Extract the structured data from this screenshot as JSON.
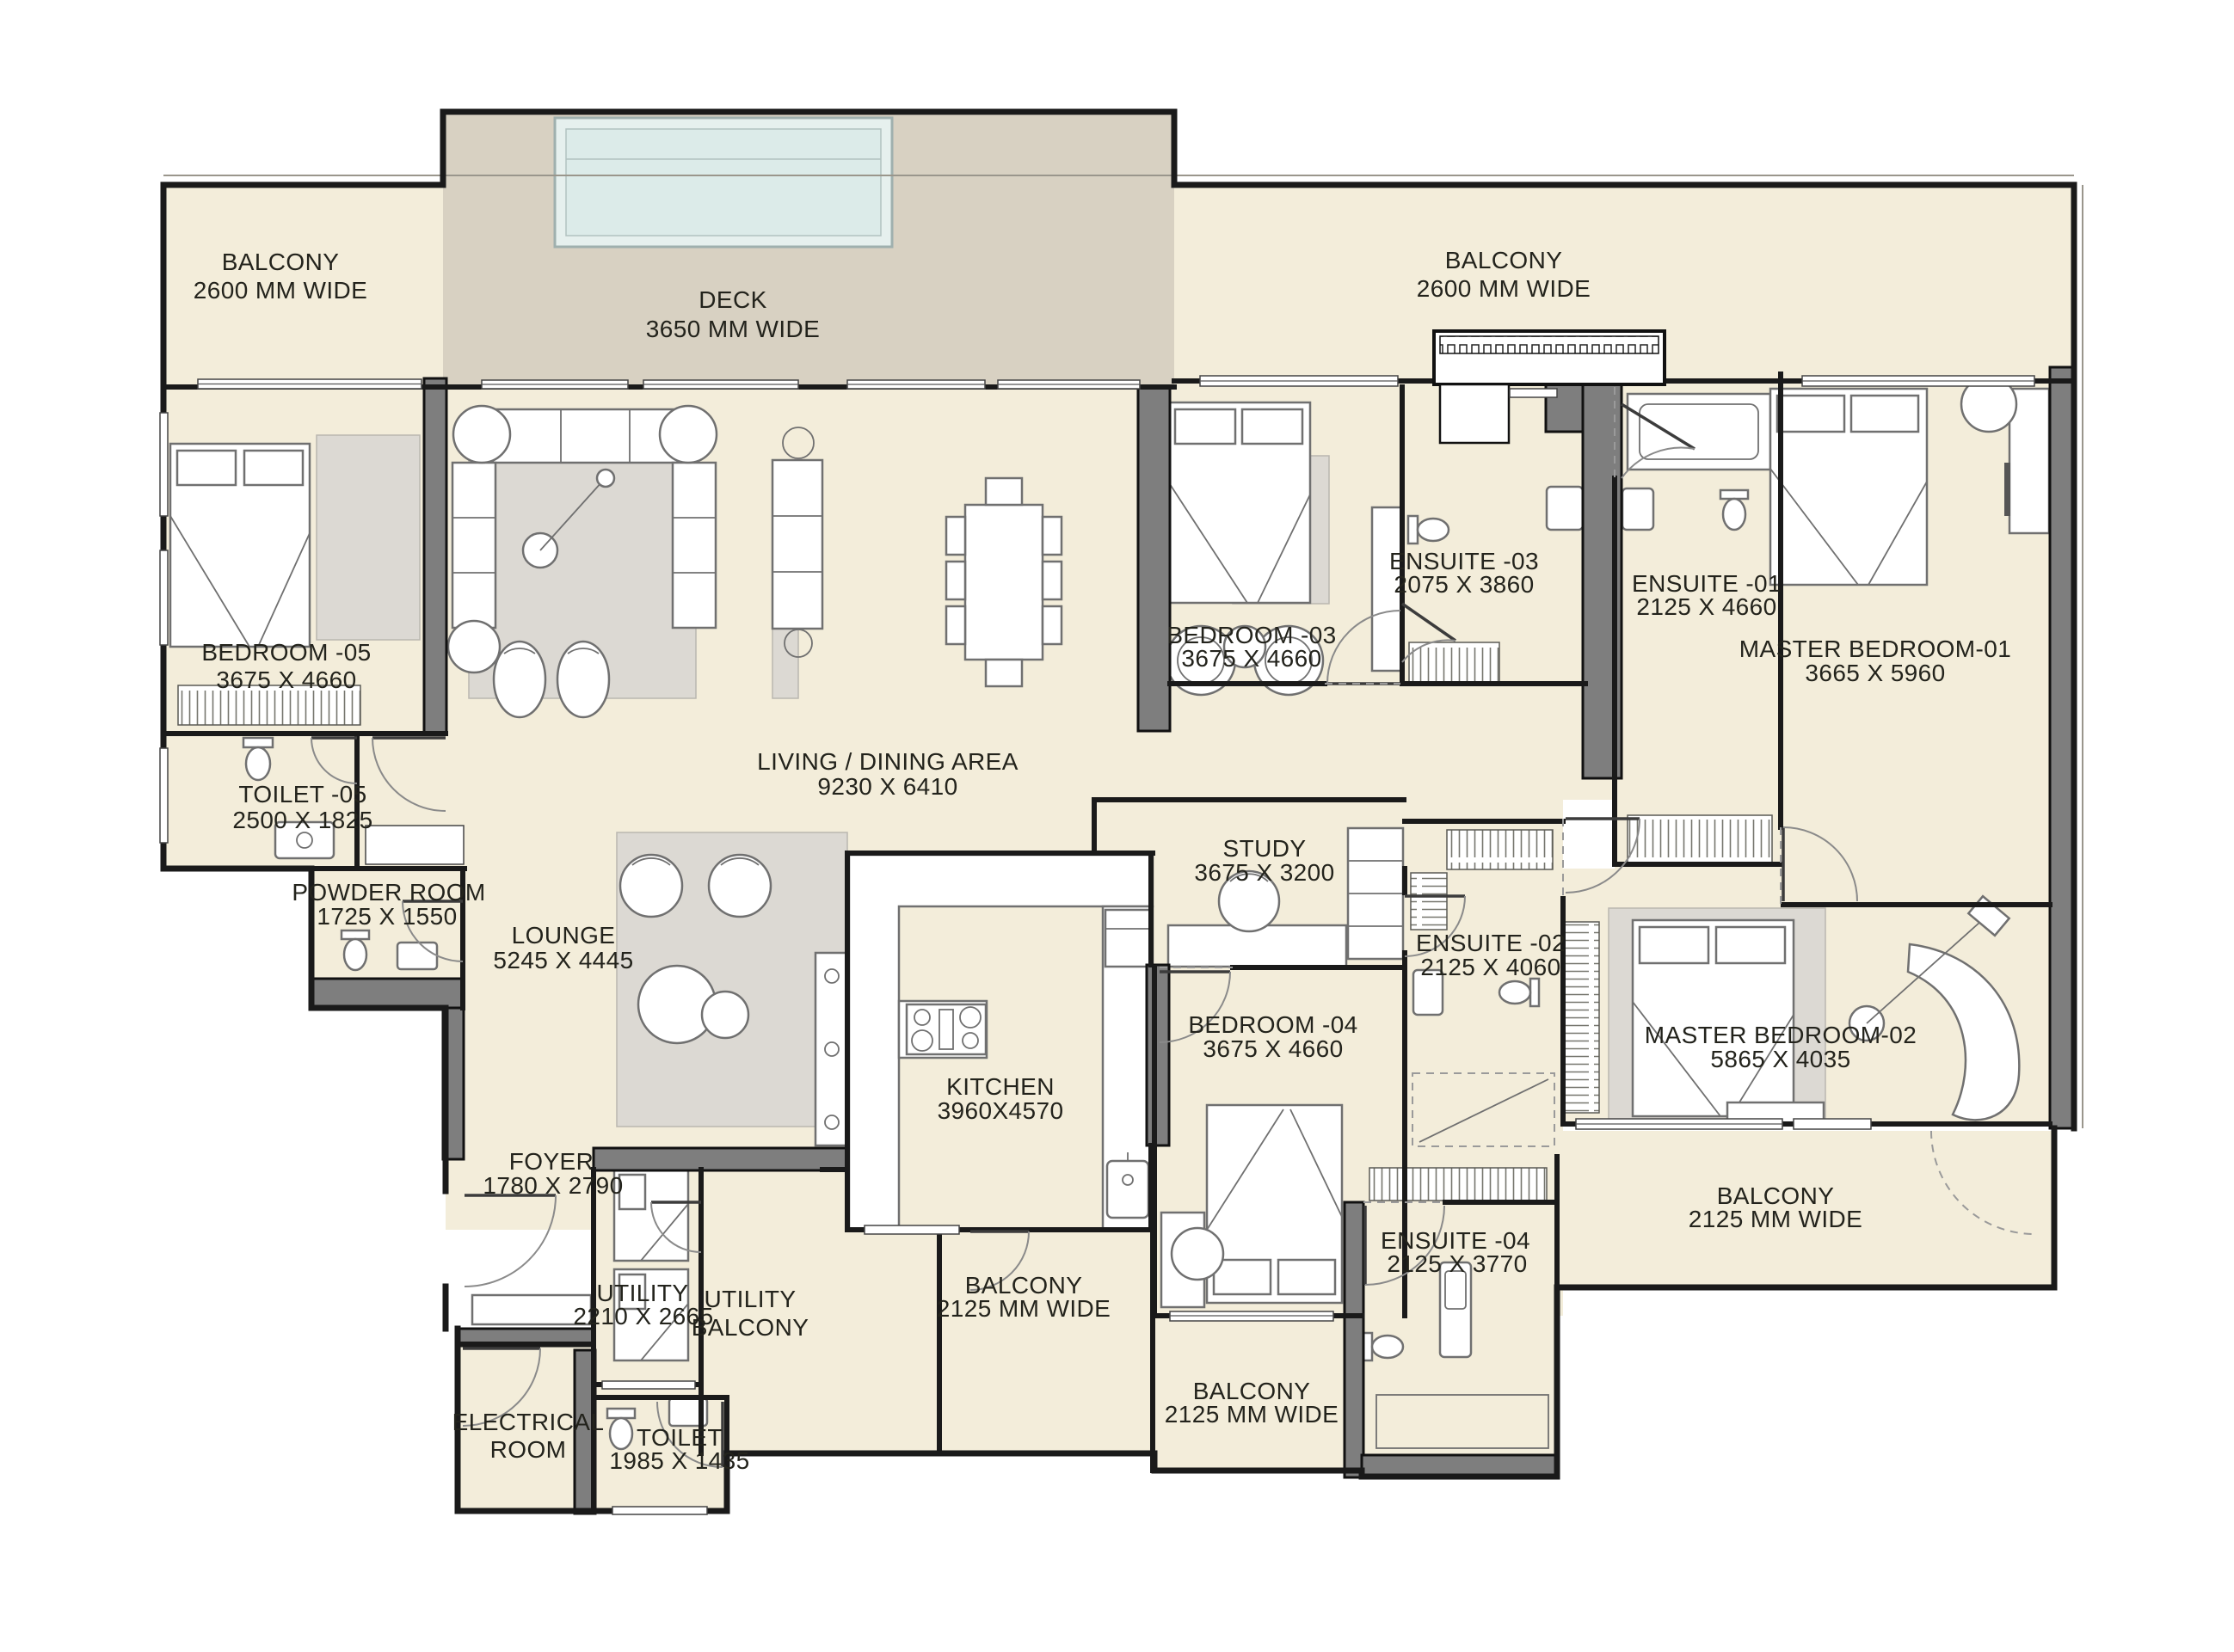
{
  "plan_title": "apartment floor plan",
  "palette": {
    "floor_cream": "#f3edda",
    "deck_taupe": "#d8d1c2",
    "pool_blue": "#dcebe9",
    "wall_black": "#1a1a1a",
    "wall_gray": "#7e7e7e",
    "furniture_stroke": "#707070",
    "rug_gray": "#dcd9d3",
    "label_color": "#23231c"
  },
  "rooms": [
    {
      "id": "balcony-top-left",
      "line1": "BALCONY",
      "line2": "2600 MM WIDE"
    },
    {
      "id": "deck",
      "line1": "DECK",
      "line2": "3650 MM WIDE"
    },
    {
      "id": "balcony-top-right",
      "line1": "BALCONY",
      "line2": "2600 MM WIDE"
    },
    {
      "id": "bedroom-05",
      "line1": "BEDROOM -05",
      "line2": "3675 X 4660"
    },
    {
      "id": "toilet-05",
      "line1": "TOILET -05",
      "line2": "2500 X 1825"
    },
    {
      "id": "powder-room",
      "line1": "POWDER  ROOM",
      "line2": "1725 X 1550"
    },
    {
      "id": "living-dining",
      "line1": "LIVING / DINING AREA",
      "line2": "9230 X 6410"
    },
    {
      "id": "lounge",
      "line1": "LOUNGE",
      "line2": "5245 X 4445"
    },
    {
      "id": "bedroom-03",
      "line1": "BEDROOM -03",
      "line2": "3675 X 4660"
    },
    {
      "id": "ensuite-03",
      "line1": "ENSUITE -03",
      "line2": "2075 X 3860"
    },
    {
      "id": "ensuite-01",
      "line1": "ENSUITE -01",
      "line2": "2125 X 4660"
    },
    {
      "id": "master-bedroom-01",
      "line1": "MASTER BEDROOM-01",
      "line2": "3665 X 5960"
    },
    {
      "id": "study",
      "line1": "STUDY",
      "line2": "3675 X 3200"
    },
    {
      "id": "ensuite-02",
      "line1": "ENSUITE -02",
      "line2": "2125 X 4060"
    },
    {
      "id": "bedroom-04",
      "line1": "BEDROOM -04",
      "line2": "3675 X 4660"
    },
    {
      "id": "master-bedroom-02",
      "line1": "MASTER BEDROOM-02",
      "line2": "5865 X 4035"
    },
    {
      "id": "kitchen",
      "line1": "KITCHEN",
      "line2": "3960X4570"
    },
    {
      "id": "foyer",
      "line1": "FOYER",
      "line2": "1780 X 2790"
    },
    {
      "id": "utility",
      "line1": "UTILITY",
      "line2": "2210 X 2665"
    },
    {
      "id": "utility-balcony",
      "line1": "UTILITY",
      "line2": "BALCONY"
    },
    {
      "id": "balcony-kitchen",
      "line1": "BALCONY",
      "line2": "2125 MM WIDE"
    },
    {
      "id": "electrical-room",
      "line1": "ELECTRICAL",
      "line2": "ROOM"
    },
    {
      "id": "toilet-bottom",
      "line1": "TOILET",
      "line2": "1985 X 1435"
    },
    {
      "id": "ensuite-04",
      "line1": "ENSUITE -04",
      "line2": "2125 X 3770"
    },
    {
      "id": "balcony-bedroom04",
      "line1": "BALCONY",
      "line2": "2125 MM WIDE"
    },
    {
      "id": "balcony-right",
      "line1": "BALCONY",
      "line2": "2125 MM WIDE"
    }
  ]
}
